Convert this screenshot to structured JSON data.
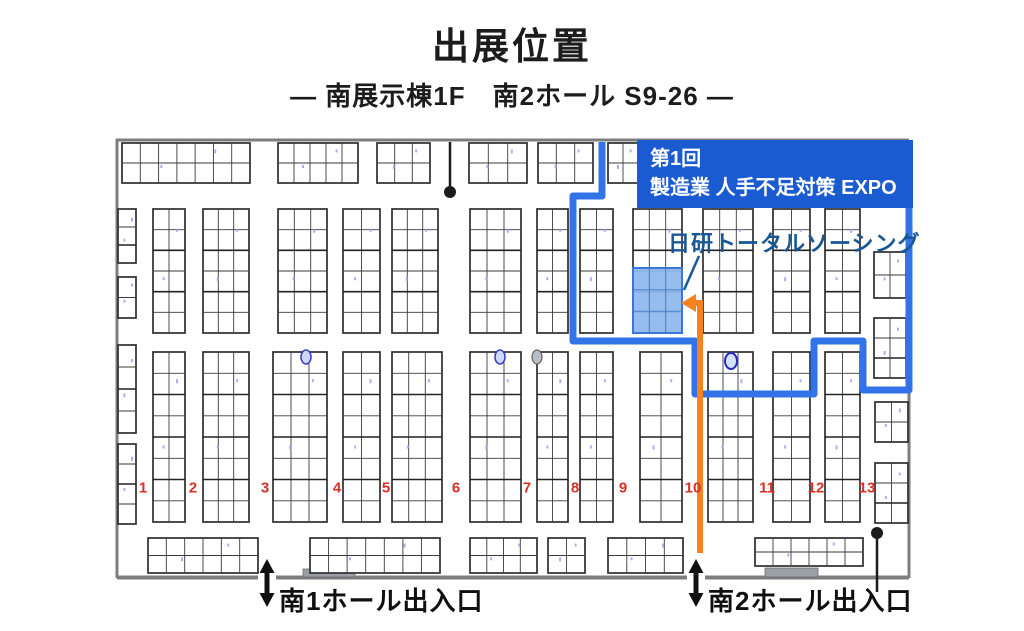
{
  "page": {
    "title": "出展位置",
    "subtitle": "― 南展示棟1F　南2ホール S9-26 ―",
    "background": "#ffffff"
  },
  "banner": {
    "line1": "第1回",
    "line2": "製造業 人手不足対策 EXPO",
    "bg_color": "#1b5bd2",
    "text_color": "#ffffff"
  },
  "exhibitor": {
    "name": "日研トータルソーシング",
    "booth_code": "S9-26",
    "label_color": "#1a5796",
    "booth_fill": "#8db7ec",
    "booth_border": "#3b76d9"
  },
  "map": {
    "column_numbers": [
      "1",
      "2",
      "3",
      "4",
      "5",
      "6",
      "7",
      "8",
      "9",
      "10",
      "11",
      "12",
      "13"
    ],
    "column_number_color": "#d93025",
    "route_color": "#3273e8",
    "arrow_color": "#f5821f",
    "wall_color": "#7d7d7d",
    "booth_line_color": "#2e2e2e",
    "entrances": [
      {
        "label": "南1ホール出入口"
      },
      {
        "label": "南2ホール出入口"
      }
    ]
  }
}
